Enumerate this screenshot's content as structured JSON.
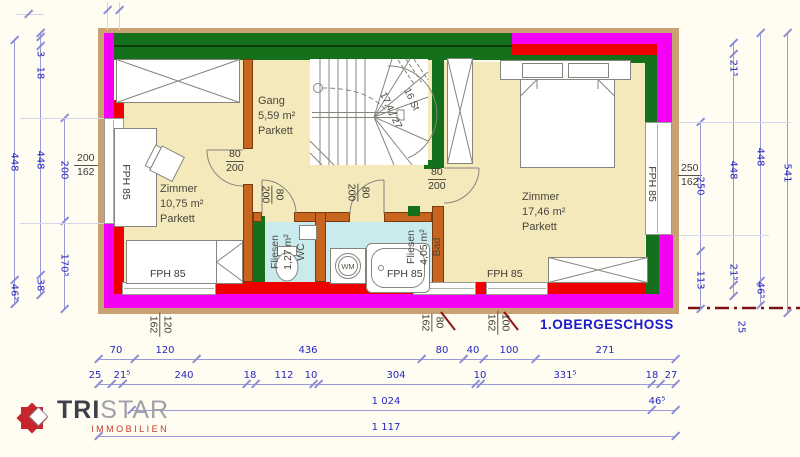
{
  "title": "1.OBERGESCHOSS",
  "logo": {
    "brand_bold": "TRI",
    "brand_light": "STAR",
    "subtitle": "IMMOBILIEN"
  },
  "rooms": {
    "zimmer_left": {
      "name": "Zimmer",
      "area": "10,75 m²",
      "floor": "Parkett"
    },
    "gang": {
      "name": "Gang",
      "area": "5,59 m²",
      "floor": "Parkett"
    },
    "zimmer_right": {
      "name": "Zimmer",
      "area": "17,46 m²",
      "floor": "Parkett"
    },
    "wc": {
      "name": "WC",
      "area": "1,27 m²",
      "floor": "Fliesen"
    },
    "bad": {
      "name": "Bad",
      "area": "4,05 m²",
      "floor": "Fliesen"
    }
  },
  "stair": {
    "steps": "16 St",
    "ratio": "17,4 / 27"
  },
  "fixtures": {
    "washing_machine": "WM"
  },
  "window_type": "FPH 85",
  "door_size": {
    "width": "80",
    "height": "200"
  },
  "window_sizes": {
    "left": {
      "top": "200",
      "bottom": "162"
    },
    "right": {
      "top": "250",
      "bottom": "162"
    },
    "bottom_left": {
      "top": "120",
      "bottom": "162"
    },
    "bottom_mid": {
      "top": "80",
      "bottom": "162"
    },
    "bottom_right": {
      "top": "100",
      "bottom": "162"
    }
  },
  "dims": {
    "bottom_row1": [
      "70",
      "120",
      "436",
      "80",
      "40",
      "100",
      "271"
    ],
    "bottom_row2": [
      "25",
      "21⁵",
      "240",
      "18",
      "112",
      "10",
      "304",
      "10",
      "331⁵",
      "18",
      "27"
    ],
    "bottom_row3": [
      "1 024",
      "46⁵"
    ],
    "bottom_row4": [
      "1 117"
    ],
    "left_col1": [
      "448",
      "46⁵"
    ],
    "left_col2": [
      "3",
      "18",
      "448",
      "38"
    ],
    "left_col3": [
      "200",
      "170⁵"
    ],
    "right_col1": [
      "250",
      "113"
    ],
    "right_col2": [
      "21⁵",
      "448",
      "21⁵"
    ],
    "right_col3": [
      "448",
      "46⁵"
    ],
    "right_col4": [
      "541"
    ],
    "section_offset": "25"
  }
}
